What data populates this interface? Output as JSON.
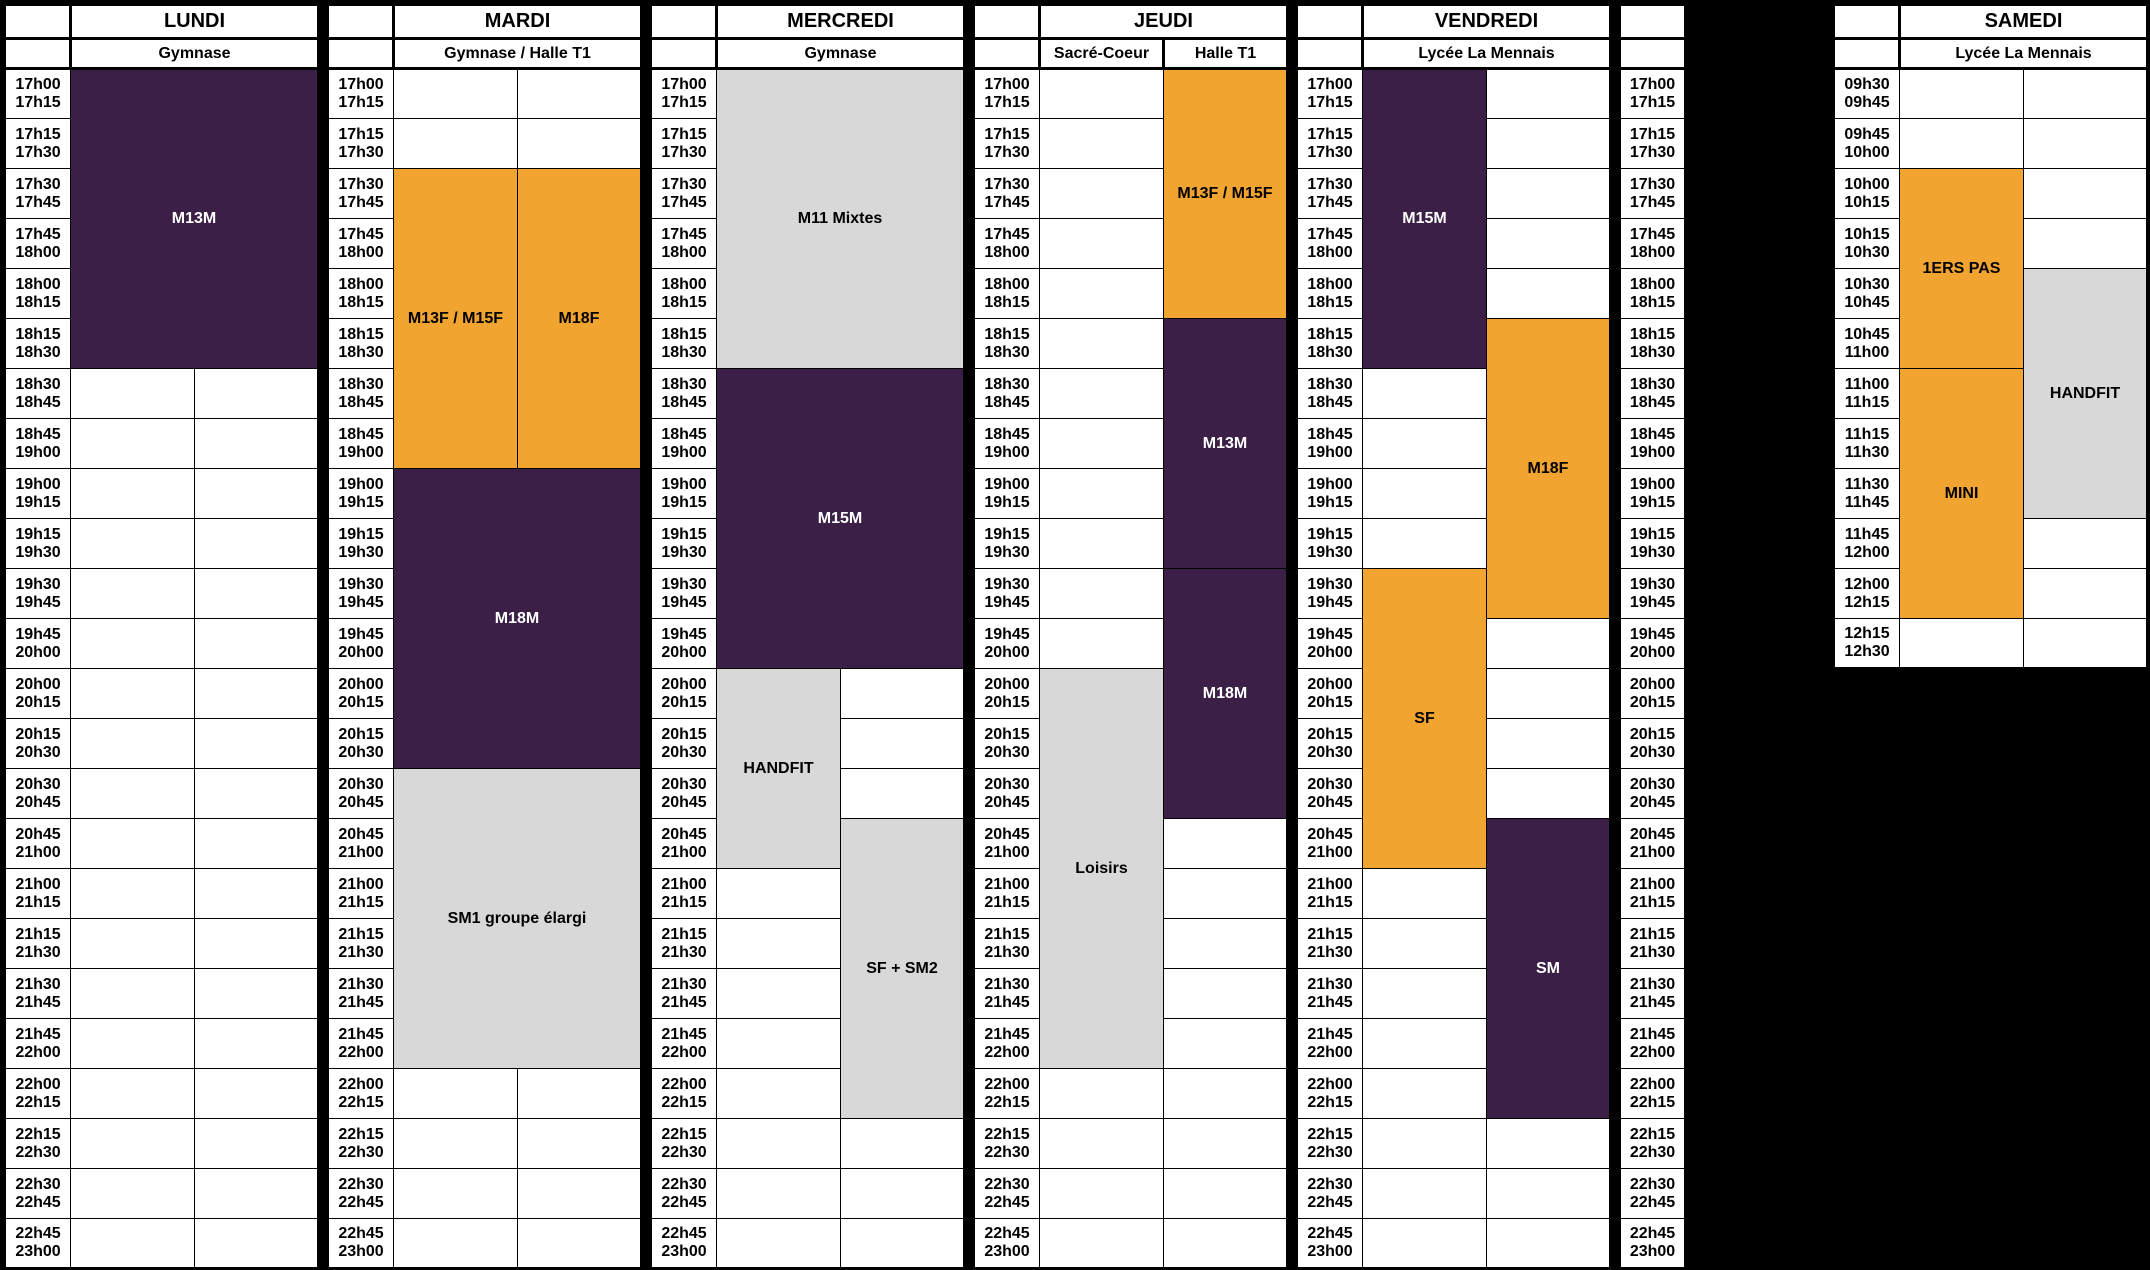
{
  "palette": {
    "purple": "#3c1f47",
    "orange": "#f2a430",
    "gray": "#d8d8d8",
    "cell_white": "#ffffff",
    "border_black": "#000000",
    "text_dark": "#000000",
    "text_light": "#ffffff"
  },
  "time_slots": {
    "weekday": [
      [
        "17h00",
        "17h15"
      ],
      [
        "17h15",
        "17h30"
      ],
      [
        "17h30",
        "17h45"
      ],
      [
        "17h45",
        "18h00"
      ],
      [
        "18h00",
        "18h15"
      ],
      [
        "18h15",
        "18h30"
      ],
      [
        "18h30",
        "18h45"
      ],
      [
        "18h45",
        "19h00"
      ],
      [
        "19h00",
        "19h15"
      ],
      [
        "19h15",
        "19h30"
      ],
      [
        "19h30",
        "19h45"
      ],
      [
        "19h45",
        "20h00"
      ],
      [
        "20h00",
        "20h15"
      ],
      [
        "20h15",
        "20h30"
      ],
      [
        "20h30",
        "20h45"
      ],
      [
        "20h45",
        "21h00"
      ],
      [
        "21h00",
        "21h15"
      ],
      [
        "21h15",
        "21h30"
      ],
      [
        "21h30",
        "21h45"
      ],
      [
        "21h45",
        "22h00"
      ],
      [
        "22h00",
        "22h15"
      ],
      [
        "22h15",
        "22h30"
      ],
      [
        "22h30",
        "22h45"
      ],
      [
        "22h45",
        "23h00"
      ]
    ],
    "saturday": [
      [
        "09h30",
        "09h45"
      ],
      [
        "09h45",
        "10h00"
      ],
      [
        "10h00",
        "10h15"
      ],
      [
        "10h15",
        "10h30"
      ],
      [
        "10h30",
        "10h45"
      ],
      [
        "10h45",
        "11h00"
      ],
      [
        "11h00",
        "11h15"
      ],
      [
        "11h15",
        "11h30"
      ],
      [
        "11h30",
        "11h45"
      ],
      [
        "11h45",
        "12h00"
      ],
      [
        "12h00",
        "12h15"
      ],
      [
        "12h15",
        "12h30"
      ]
    ]
  },
  "days": [
    {
      "name": "LUNDI",
      "slots": "weekday",
      "thick_divider": false,
      "venues": [
        {
          "label": "Gymnase",
          "span": 2
        }
      ],
      "events": [
        {
          "label": "M13M",
          "col": 0,
          "colspan": 2,
          "start": 0,
          "end": 6,
          "color": "purple",
          "text": "light"
        }
      ]
    },
    {
      "name": "MARDI",
      "slots": "weekday",
      "thick_divider": false,
      "venues": [
        {
          "label": "Gymnase / Halle T1",
          "span": 2
        }
      ],
      "events": [
        {
          "label": "M13F / M15F",
          "col": 0,
          "colspan": 1,
          "start": 2,
          "end": 8,
          "color": "orange",
          "text": "dark"
        },
        {
          "label": "M18F",
          "col": 1,
          "colspan": 1,
          "start": 2,
          "end": 8,
          "color": "orange",
          "text": "dark"
        },
        {
          "label": "M18M",
          "col": 0,
          "colspan": 2,
          "start": 8,
          "end": 14,
          "color": "purple",
          "text": "light"
        },
        {
          "label": "SM1 groupe élargi",
          "col": 0,
          "colspan": 2,
          "start": 14,
          "end": 20,
          "color": "gray",
          "text": "dark"
        }
      ]
    },
    {
      "name": "MERCREDI",
      "slots": "weekday",
      "thick_divider": false,
      "venues": [
        {
          "label": "Gymnase",
          "span": 2
        }
      ],
      "events": [
        {
          "label": "M11 Mixtes",
          "col": 0,
          "colspan": 2,
          "start": 0,
          "end": 6,
          "color": "gray",
          "text": "dark"
        },
        {
          "label": "M15M",
          "col": 0,
          "colspan": 2,
          "start": 6,
          "end": 12,
          "color": "purple",
          "text": "light"
        },
        {
          "label": "HANDFIT",
          "col": 0,
          "colspan": 1,
          "start": 12,
          "end": 16,
          "color": "gray",
          "text": "dark"
        },
        {
          "label": "SF + SM2",
          "col": 1,
          "colspan": 1,
          "start": 15,
          "end": 21,
          "color": "gray",
          "text": "dark"
        }
      ]
    },
    {
      "name": "JEUDI",
      "slots": "weekday",
      "thick_divider": true,
      "venues": [
        {
          "label": "Sacré-Coeur",
          "span": 1
        },
        {
          "label": "Halle T1",
          "span": 1
        }
      ],
      "events": [
        {
          "label": "M13F / M15F",
          "col": 1,
          "colspan": 1,
          "start": 0,
          "end": 5,
          "color": "orange",
          "text": "dark"
        },
        {
          "label": "M13M",
          "col": 1,
          "colspan": 1,
          "start": 5,
          "end": 10,
          "color": "purple",
          "text": "light"
        },
        {
          "label": "M18M",
          "col": 1,
          "colspan": 1,
          "start": 10,
          "end": 15,
          "color": "purple",
          "text": "light"
        },
        {
          "label": "Loisirs",
          "col": 0,
          "colspan": 1,
          "start": 12,
          "end": 20,
          "color": "gray",
          "text": "dark"
        }
      ]
    },
    {
      "name": "VENDREDI",
      "slots": "weekday",
      "thick_divider": false,
      "venues": [
        {
          "label": "Lycée La Mennais",
          "span": 2
        }
      ],
      "events": [
        {
          "label": "M15M",
          "col": 0,
          "colspan": 1,
          "start": 0,
          "end": 6,
          "color": "purple",
          "text": "light"
        },
        {
          "label": "M18F",
          "col": 1,
          "colspan": 1,
          "start": 5,
          "end": 11,
          "color": "orange",
          "text": "dark"
        },
        {
          "label": "SF",
          "col": 0,
          "colspan": 1,
          "start": 10,
          "end": 16,
          "color": "orange",
          "text": "dark"
        },
        {
          "label": "SM",
          "col": 1,
          "colspan": 1,
          "start": 15,
          "end": 21,
          "color": "purple",
          "text": "light"
        }
      ]
    },
    {
      "name": "SAMEDI",
      "slots": "saturday",
      "thick_divider": false,
      "venues": [
        {
          "label": "Lycée La Mennais",
          "span": 2
        }
      ],
      "events": [
        {
          "label": "1ERS PAS",
          "col": 0,
          "colspan": 1,
          "start": 2,
          "end": 6,
          "color": "orange",
          "text": "dark"
        },
        {
          "label": "MINI",
          "col": 0,
          "colspan": 1,
          "start": 6,
          "end": 11,
          "color": "orange",
          "text": "dark"
        },
        {
          "label": "HANDFIT",
          "col": 1,
          "colspan": 1,
          "start": 4,
          "end": 9,
          "color": "gray",
          "text": "dark"
        }
      ]
    }
  ],
  "trailing_time_column": {
    "slots": "weekday"
  }
}
